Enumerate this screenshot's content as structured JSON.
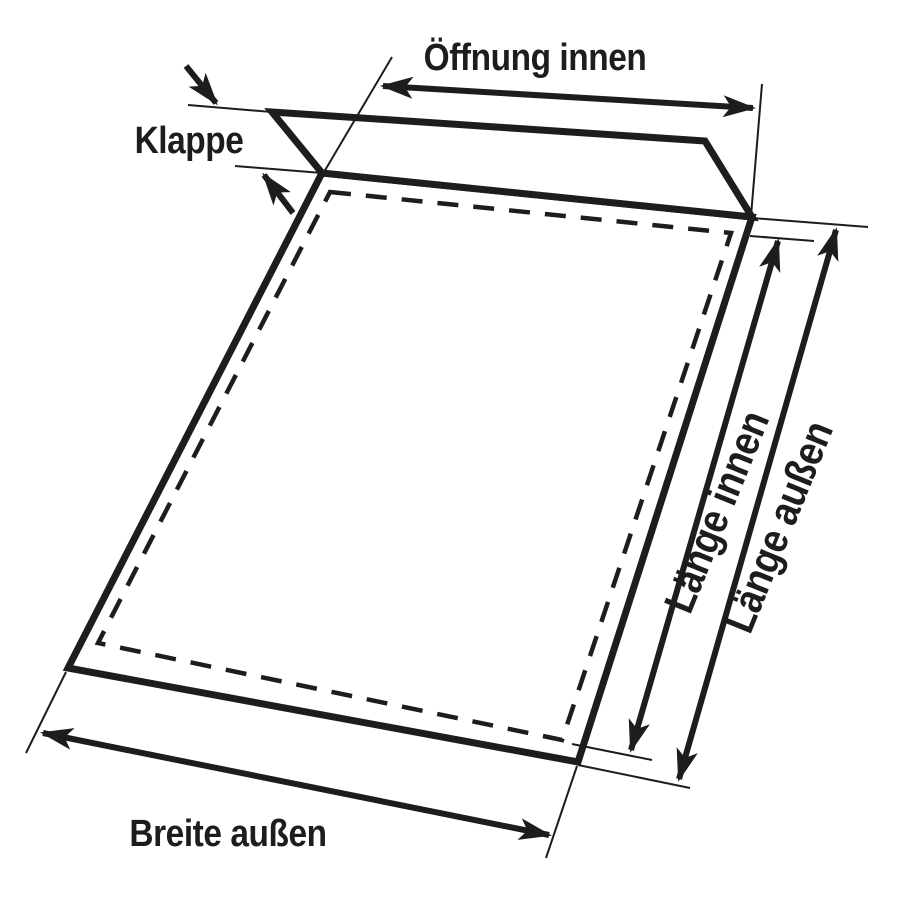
{
  "diagram": {
    "type": "envelope-dimension-drawing",
    "labels": {
      "klappe": "Klappe",
      "oeffnung_innen": "Öffnung innen",
      "laenge_innen": "Länge innen",
      "laenge_aussen": "Länge außen",
      "breite_aussen": "Breite außen"
    },
    "colors": {
      "ink": "#1d1d1b",
      "background": "#ffffff"
    }
  }
}
